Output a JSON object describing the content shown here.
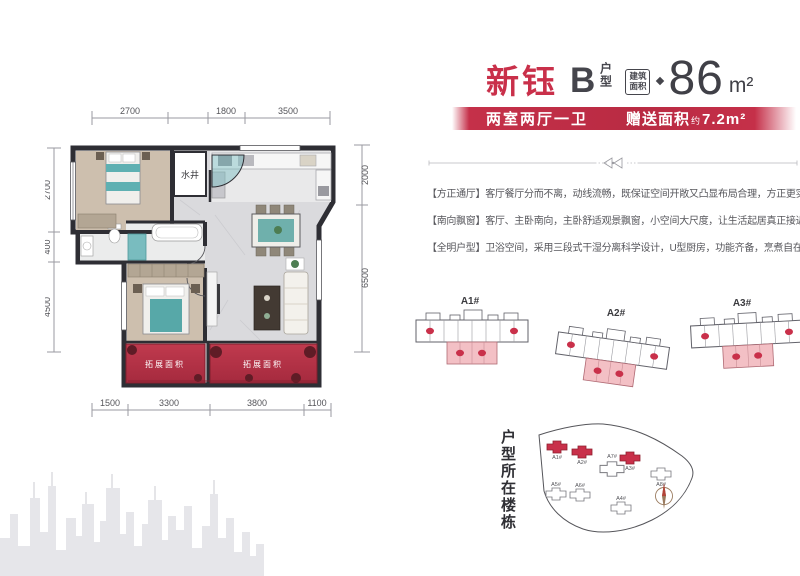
{
  "header": {
    "project_name": "新钰",
    "unit_letter": "B",
    "unit_suffix": "户型",
    "area_badge_line1": "建筑",
    "area_badge_line2": "面积",
    "area_value": "86",
    "area_unit": "m²",
    "banner_left": "两室两厅一卫",
    "banner_right_label": "赠送面积",
    "banner_right_approx": "约",
    "banner_right_value": "7.2m²"
  },
  "features": [
    "【方正通厅】客厅餐厅分而不离，动线流畅，既保证空间开敞又凸显布局合理，方正更实用；",
    "【南向飘窗】客厅、主卧南向，主卧舒适观景飘窗，小空间大尺度，让生活起居真正接近阳光；",
    "【全明户型】卫浴空间，采用三段式干湿分离科学设计，U型厨房，功能齐备，烹煮自在随心；"
  ],
  "floorplan": {
    "water_shaft_label": "水井",
    "balcony_left_label": "拓展面积",
    "balcony_right_label": "拓展面积",
    "dims_top": [
      "2700",
      "1800",
      "3500"
    ],
    "dims_left": [
      "2700",
      "400",
      "4500"
    ],
    "dims_right": [
      "2000",
      "6500"
    ],
    "dims_bottom": [
      "1500",
      "3300",
      "3800",
      "1100"
    ]
  },
  "unit_locations": {
    "labels": [
      "A1#",
      "A2#",
      "A3#"
    ]
  },
  "siteplan": {
    "title": "户型所在楼栋",
    "buildings": [
      {
        "label": "A1#",
        "highlight": true
      },
      {
        "label": "A2#",
        "highlight": true
      },
      {
        "label": "A7#",
        "highlight": false
      },
      {
        "label": "A3#",
        "highlight": true
      },
      {
        "label": "A8#",
        "highlight": false
      },
      {
        "label": "A5#",
        "highlight": false
      },
      {
        "label": "A6#",
        "highlight": false
      },
      {
        "label": "A4#",
        "highlight": false
      }
    ]
  },
  "colors": {
    "accent_red": "#c9304a",
    "teal": "#5fb0b2",
    "wall_dark": "#2e2e34"
  }
}
